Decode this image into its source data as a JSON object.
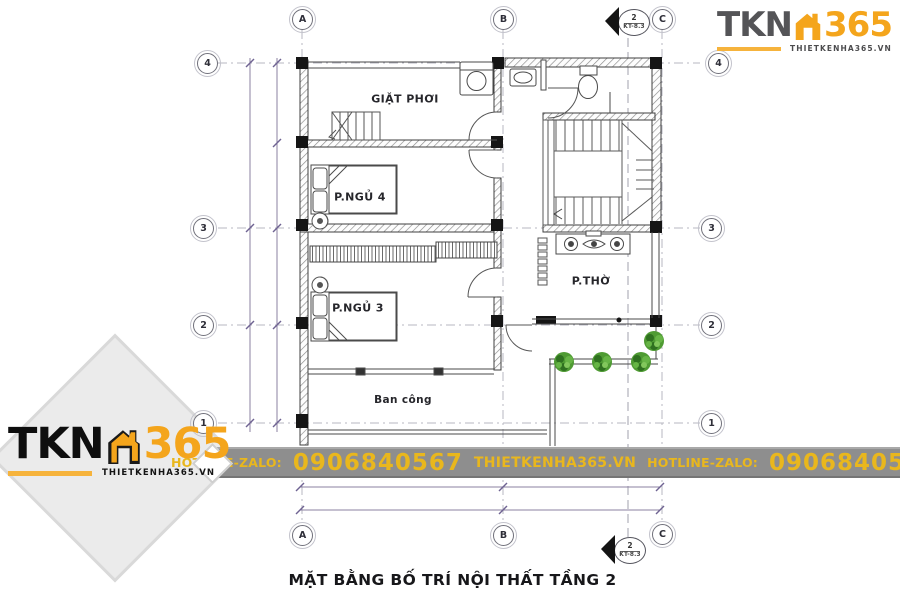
{
  "brand": {
    "tkn": "TKN",
    "n365": "365",
    "domain": "THIETKENHA365.VN"
  },
  "banner": {
    "hotline_label": "HOTLINE-ZALO:",
    "phone": "0906840567",
    "website": "THIETKENHA365.VN",
    "hotline_label_2": "HOTLINE-ZALO:",
    "phone_2": "0906840567"
  },
  "plan": {
    "caption": "MẶT BẰNG BỐ TRÍ NỘI THẤT TẦNG 2",
    "rooms": {
      "laundry": "GIẶT PHƠI",
      "bedroom4": "P.NGỦ 4",
      "bedroom3": "P.NGỦ 3",
      "worship": "P.THỜ",
      "balcony": "Ban công"
    },
    "grid": {
      "cols": [
        "A",
        "B",
        "C"
      ],
      "rows": [
        "4",
        "3",
        "2",
        "1"
      ]
    },
    "section_marker": {
      "number": "2",
      "sheet": "KT-8.3"
    }
  },
  "colors": {
    "accent_orange": "#f4a51c",
    "banner_gray": "#8e8e8e",
    "banner_yellow": "#e9b71d",
    "plant_green": "#4f9b33",
    "dimension_purple": "#6f6392"
  }
}
